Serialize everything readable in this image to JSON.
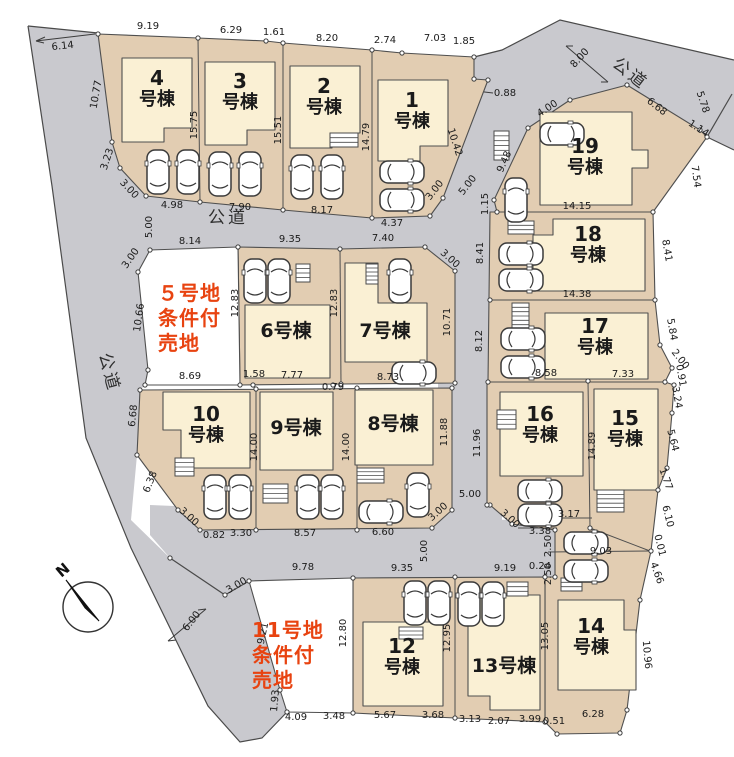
{
  "map": {
    "compass": {
      "label": "N"
    },
    "road_labels": [
      {
        "t": "公道",
        "x": 228,
        "y": 223,
        "r": 0
      },
      {
        "t": "公道",
        "x": 627,
        "y": 78,
        "r": 38
      },
      {
        "t": "公道",
        "x": 104,
        "y": 374,
        "r": 75
      }
    ],
    "sale_lots": [
      {
        "name": "5号地条件付売地",
        "lines": [
          "５号地",
          "条件付",
          "売地"
        ],
        "x": 158,
        "y": 300
      },
      {
        "name": "11号地条件付売地",
        "lines": [
          "11号地",
          "条件付",
          "売地"
        ],
        "x": 252,
        "y": 637
      }
    ],
    "buildings": [
      {
        "name": "1号棟",
        "lines": [
          "1",
          "号棟"
        ],
        "x": 412,
        "y": 112
      },
      {
        "name": "2号棟",
        "lines": [
          "2",
          "号棟"
        ],
        "x": 324,
        "y": 98
      },
      {
        "name": "3号棟",
        "lines": [
          "3",
          "号棟"
        ],
        "x": 240,
        "y": 93
      },
      {
        "name": "4号棟",
        "lines": [
          "4",
          "号棟"
        ],
        "x": 157,
        "y": 90
      },
      {
        "name": "6号棟",
        "lines": [
          "6号棟"
        ],
        "x": 286,
        "y": 331
      },
      {
        "name": "7号棟",
        "lines": [
          "7号棟"
        ],
        "x": 385,
        "y": 331
      },
      {
        "name": "8号棟",
        "lines": [
          "8号棟"
        ],
        "x": 393,
        "y": 424
      },
      {
        "name": "9号棟",
        "lines": [
          "9号棟"
        ],
        "x": 296,
        "y": 428
      },
      {
        "name": "10号棟",
        "lines": [
          "10",
          "号棟"
        ],
        "x": 206,
        "y": 426
      },
      {
        "name": "12号棟",
        "lines": [
          "12",
          "号棟"
        ],
        "x": 402,
        "y": 658
      },
      {
        "name": "13号棟",
        "lines": [
          "13号棟"
        ],
        "x": 504,
        "y": 666
      },
      {
        "name": "14号棟",
        "lines": [
          "14",
          "号棟"
        ],
        "x": 591,
        "y": 638
      },
      {
        "name": "15号棟",
        "lines": [
          "15",
          "号棟"
        ],
        "x": 625,
        "y": 430
      },
      {
        "name": "16号棟",
        "lines": [
          "16",
          "号棟"
        ],
        "x": 540,
        "y": 426
      },
      {
        "name": "17号棟",
        "lines": [
          "17",
          "号棟"
        ],
        "x": 595,
        "y": 338
      },
      {
        "name": "18号棟",
        "lines": [
          "18",
          "号棟"
        ],
        "x": 588,
        "y": 246
      },
      {
        "name": "19号棟",
        "lines": [
          "19",
          "号棟"
        ],
        "x": 585,
        "y": 158
      }
    ],
    "dims": [
      [
        "9.19",
        148,
        29,
        0
      ],
      [
        "6.29",
        231,
        33,
        0
      ],
      [
        "1.61",
        274,
        35,
        0
      ],
      [
        "8.20",
        327,
        41,
        0
      ],
      [
        "2.74",
        385,
        43,
        0
      ],
      [
        "7.03",
        435,
        41,
        0
      ],
      [
        "1.85",
        464,
        44,
        0
      ],
      [
        "6.14",
        63,
        49,
        -6
      ],
      [
        "10.77",
        99,
        95,
        -80
      ],
      [
        "3.23",
        110,
        160,
        -72
      ],
      [
        "3.00",
        127,
        191,
        47
      ],
      [
        "15.75",
        197,
        125,
        -90
      ],
      [
        "15.51",
        281,
        130,
        -90
      ],
      [
        "14.79",
        369,
        137,
        -90
      ],
      [
        "0.88",
        505,
        96,
        0
      ],
      [
        "10.42",
        452,
        143,
        72
      ],
      [
        "4.98",
        172,
        208,
        0
      ],
      [
        "7.90",
        240,
        210,
        0
      ],
      [
        "8.17",
        322,
        213,
        0
      ],
      [
        "4.37",
        392,
        226,
        0
      ],
      [
        "3.00",
        437,
        192,
        -52
      ],
      [
        "5.00",
        470,
        187,
        -52
      ],
      [
        "5.00",
        152,
        227,
        -90
      ],
      [
        "3.00",
        133,
        260,
        -55
      ],
      [
        "8.00",
        582,
        60,
        -48
      ],
      [
        "4.00",
        549,
        111,
        -33
      ],
      [
        "6.68",
        655,
        109,
        38
      ],
      [
        "5.78",
        700,
        103,
        72
      ],
      [
        "1.14",
        697,
        131,
        33
      ],
      [
        "7.54",
        693,
        177,
        82
      ],
      [
        "9.48",
        507,
        163,
        -66
      ],
      [
        "1.15",
        488,
        204,
        -90
      ],
      [
        "14.15",
        577,
        209,
        0
      ],
      [
        "8.41",
        483,
        253,
        -90
      ],
      [
        "8.41",
        664,
        251,
        80
      ],
      [
        "14.38",
        577,
        297,
        0
      ],
      [
        "8.12",
        482,
        341,
        -90
      ],
      [
        "5.84",
        669,
        330,
        80
      ],
      [
        "2.00",
        678,
        361,
        52
      ],
      [
        "8.58",
        546,
        376,
        0
      ],
      [
        "7.33",
        623,
        377,
        0
      ],
      [
        "0.91",
        678,
        376,
        80
      ],
      [
        "3.24",
        674,
        398,
        80
      ],
      [
        "11.96",
        480,
        443,
        -90
      ],
      [
        "14.89",
        595,
        446,
        -90
      ],
      [
        "5.64",
        670,
        441,
        76
      ],
      [
        "1.77",
        663,
        480,
        70
      ],
      [
        "6.10",
        665,
        517,
        76
      ],
      [
        "0.01",
        657,
        546,
        76
      ],
      [
        "4.66",
        654,
        574,
        70
      ],
      [
        "10.96",
        644,
        655,
        85
      ],
      [
        "3.17",
        569,
        517,
        0
      ],
      [
        "3.38",
        540,
        534,
        0
      ],
      [
        "2.50",
        551,
        546,
        -90
      ],
      [
        "2.50",
        551,
        574,
        -90
      ],
      [
        "9.03",
        601,
        554,
        0
      ],
      [
        "0.24",
        540,
        569,
        0
      ],
      [
        "9.19",
        505,
        571,
        0
      ],
      [
        "13.05",
        548,
        636,
        -90
      ],
      [
        "12.95",
        450,
        638,
        -90
      ],
      [
        "12.80",
        346,
        633,
        -90
      ],
      [
        "9.35",
        402,
        571,
        0
      ],
      [
        "9.78",
        303,
        570,
        0
      ],
      [
        "5.00",
        470,
        497,
        0
      ],
      [
        "3.00",
        440,
        514,
        -42
      ],
      [
        "3.00",
        508,
        521,
        42
      ],
      [
        "5.00",
        427,
        551,
        -90
      ],
      [
        "3.00",
        238,
        588,
        -30
      ],
      [
        "6.00",
        194,
        623,
        -52
      ],
      [
        "9.21",
        266,
        634,
        -78
      ],
      [
        "1.93",
        278,
        701,
        -85
      ],
      [
        "4.09",
        296,
        720,
        0
      ],
      [
        "3.48",
        334,
        719,
        0
      ],
      [
        "5.67",
        385,
        718,
        0
      ],
      [
        "3.68",
        433,
        718,
        0
      ],
      [
        "3.13",
        470,
        722,
        0
      ],
      [
        "2.07",
        499,
        724,
        0
      ],
      [
        "3.99",
        530,
        722,
        0
      ],
      [
        "0.51",
        554,
        724,
        0
      ],
      [
        "6.28",
        593,
        717,
        0
      ],
      [
        "8.14",
        190,
        244,
        0
      ],
      [
        "9.35",
        290,
        242,
        0
      ],
      [
        "7.40",
        383,
        241,
        0
      ],
      [
        "3.00",
        448,
        261,
        42
      ],
      [
        "10.66",
        142,
        318,
        -82
      ],
      [
        "12.83",
        238,
        303,
        -90
      ],
      [
        "12.83",
        337,
        303,
        -90
      ],
      [
        "10.71",
        450,
        322,
        -90
      ],
      [
        "8.69",
        190,
        379,
        0
      ],
      [
        "1.58",
        254,
        377,
        0
      ],
      [
        "7.77",
        292,
        378,
        0
      ],
      [
        "0.79",
        333,
        390,
        0
      ],
      [
        "8.73",
        388,
        380,
        0
      ],
      [
        "6.68",
        136,
        416,
        -84
      ],
      [
        "6.38",
        153,
        483,
        -68
      ],
      [
        "3.00",
        187,
        519,
        42
      ],
      [
        "0.82",
        214,
        538,
        0
      ],
      [
        "3.30",
        241,
        536,
        0
      ],
      [
        "14.00",
        257,
        447,
        -90
      ],
      [
        "14.00",
        349,
        447,
        -90
      ],
      [
        "8.57",
        305,
        536,
        0
      ],
      [
        "11.88",
        447,
        432,
        -90
      ],
      [
        "6.60",
        383,
        535,
        0
      ]
    ],
    "colors": {
      "road": "#c9c9ce",
      "lot": "#e2cdb2",
      "building": "#faf0d4",
      "sale_lot": "#ffffff",
      "outline": "#4f4f4f",
      "sale_text": "#e84310",
      "dim_text": "#1b1b1b"
    }
  }
}
